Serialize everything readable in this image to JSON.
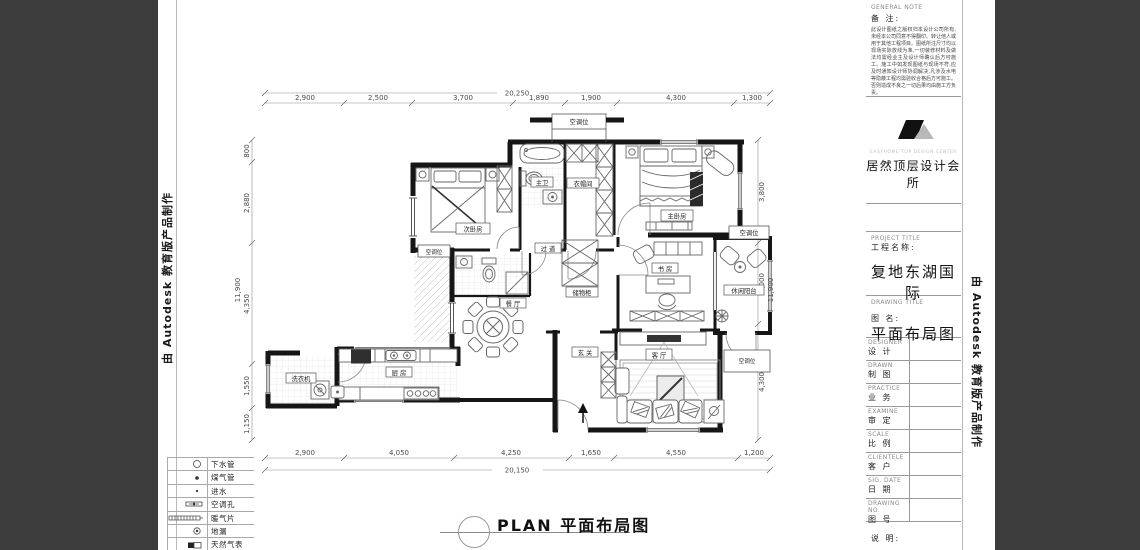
{
  "watermark": {
    "text": "由 Autodesk 教育版产品制作"
  },
  "plan_footer": {
    "title": "PLAN 平面布局图"
  },
  "dims": {
    "top": {
      "overall": "20,250",
      "segments": [
        "2,900",
        "2,500",
        "3,700",
        "1,890",
        "1,900",
        "4,300",
        "1,300"
      ]
    },
    "bottom": {
      "overall": "20,150",
      "segments": [
        "2,900",
        "4,050",
        "4,250",
        "1,650",
        "4,550",
        "1,200"
      ]
    },
    "left": {
      "overall": "11,900",
      "segments": [
        "800",
        "2,880",
        "4,350",
        "1,550",
        "1,150"
      ]
    },
    "right": {
      "overall": "11,900",
      "segments": [
        "3,800",
        "3,000",
        "4,300"
      ]
    }
  },
  "rooms": {
    "ac": "空调位",
    "bedroom2": "次卧房",
    "master_bath": "主卫",
    "cloak": "衣帽间",
    "master": "主卧房",
    "corridor": "过 道",
    "study": "书 房",
    "leisure_balcony": "休闲阳台",
    "dining": "餐 厅",
    "cabinet": "储物柜",
    "entry": "玄 关",
    "living": "客 厅",
    "kitchen": "厨 房",
    "laundry": "洗衣机"
  },
  "legend": {
    "items": [
      {
        "symbol": "drain-pipe",
        "label": "下水管"
      },
      {
        "symbol": "gas-pipe",
        "label": "煤气管"
      },
      {
        "symbol": "water-inlet",
        "label": "进水"
      },
      {
        "symbol": "ac-hole",
        "label": "空调孔"
      },
      {
        "symbol": "radiator",
        "label": "暖气片"
      },
      {
        "symbol": "floor-drain",
        "label": "地漏"
      },
      {
        "symbol": "gas-meter",
        "label": "天然气表"
      }
    ]
  },
  "title_block": {
    "general_note": {
      "en": "GENERAL NOTE",
      "zh": "备 注:",
      "body": "此设计图纸之版权归本设计公司所有,未经本公司同意不得翻印、转让他人或用于其他工程项目。图纸所注尺寸均以现场实际放线为准,一切装修材料及做法均需经业主及设计师确认后方可施工。施工中如发现图纸与现场不符,应及时通知设计师协调解决,凡涉及水电等隐蔽工程均需验收合格后方可施工。否则造成不良之一切后果均由施工方负责。"
    },
    "logo": {
      "en": "EASYHOME  TOP DESIGN CENTER",
      "zh": "居然顶层设计会所"
    },
    "project": {
      "en": "PROJECT TITLE",
      "zh": "工程名称:",
      "value": "复地东湖国际"
    },
    "drawing": {
      "en": "DRAWING TITLE",
      "zh": "图   名:",
      "value": "平面布局图"
    },
    "rows": [
      {
        "en": "DESIGNER",
        "zh": "设 计"
      },
      {
        "en": "DRAWN",
        "zh": "制 图"
      },
      {
        "en": "PRACTICE",
        "zh": "业 务"
      },
      {
        "en": "EXAMINE",
        "zh": "审 定"
      },
      {
        "en": "SCALE",
        "zh": "比 例"
      },
      {
        "en": "CLIENTELE",
        "zh": "客 户"
      },
      {
        "en": "SIG. DATE",
        "zh": "日 期"
      },
      {
        "en": "DRAWING NO.",
        "zh": "图 号"
      }
    ],
    "remark": "说 明:"
  }
}
